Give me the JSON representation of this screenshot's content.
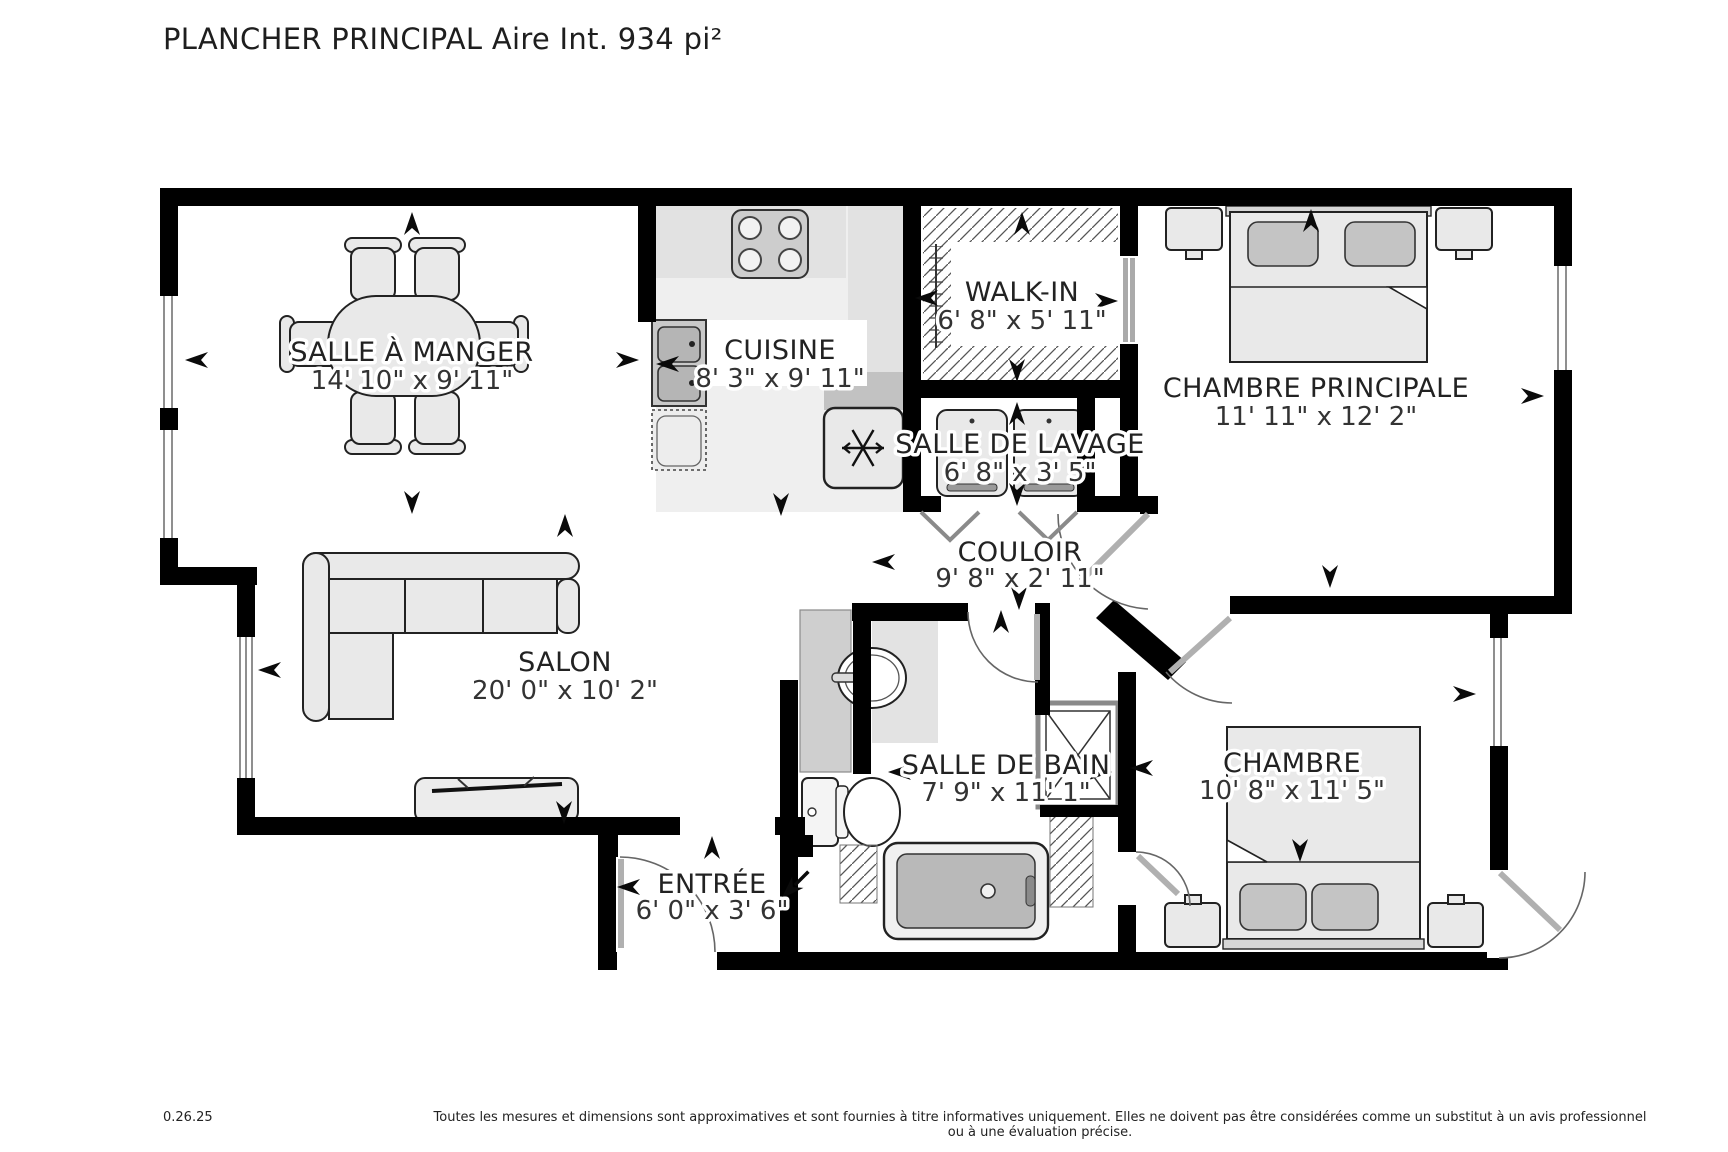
{
  "page": {
    "title": "PLANCHER PRINCIPAL Aire Int. 934 pi²"
  },
  "floor_plan": {
    "rooms": [
      {
        "name": "SALLE À MANGER",
        "dimensions": "14' 10\" x 9' 11\""
      },
      {
        "name": "CUISINE",
        "dimensions": "8' 3\" x 9' 11\""
      },
      {
        "name": "WALK-IN",
        "dimensions": "6' 8\" x 5' 11\""
      },
      {
        "name": "CHAMBRE PRINCIPALE",
        "dimensions": "11' 11\" x 12' 2\""
      },
      {
        "name": "SALLE DE LAVAGE",
        "dimensions": "6' 8\" x 3' 5\""
      },
      {
        "name": "COULOIR",
        "dimensions": "9' 8\" x 2' 11\""
      },
      {
        "name": "SALON",
        "dimensions": "20' 0\" x 10' 2\""
      },
      {
        "name": "SALLE DE BAIN",
        "dimensions": "7' 9\" x 11' 1\""
      },
      {
        "name": "ENTRÉE",
        "dimensions": "6' 0\" x 3' 6\""
      },
      {
        "name": "CHAMBRE",
        "dimensions": "10' 8\" x 11' 5\""
      }
    ],
    "icons": {
      "refrigerator": "snowflake-icon",
      "stove": "four-burner-stove-icon",
      "direction_marker": "arrow-icon",
      "closet": "hatch-lines-icon"
    },
    "colors": {
      "walls": "#000000",
      "furniture_fill": "#e9e9e9",
      "appliance_gray": "#c4c4c4",
      "text": "#1a1a1a"
    }
  },
  "footer": {
    "code": "0.26.25",
    "disclaimer": "Toutes les mesures et dimensions sont approximatives et sont fournies à titre informatives uniquement. Elles ne doivent pas être considérées comme un substitut à un avis professionnel ou à une évaluation précise."
  }
}
